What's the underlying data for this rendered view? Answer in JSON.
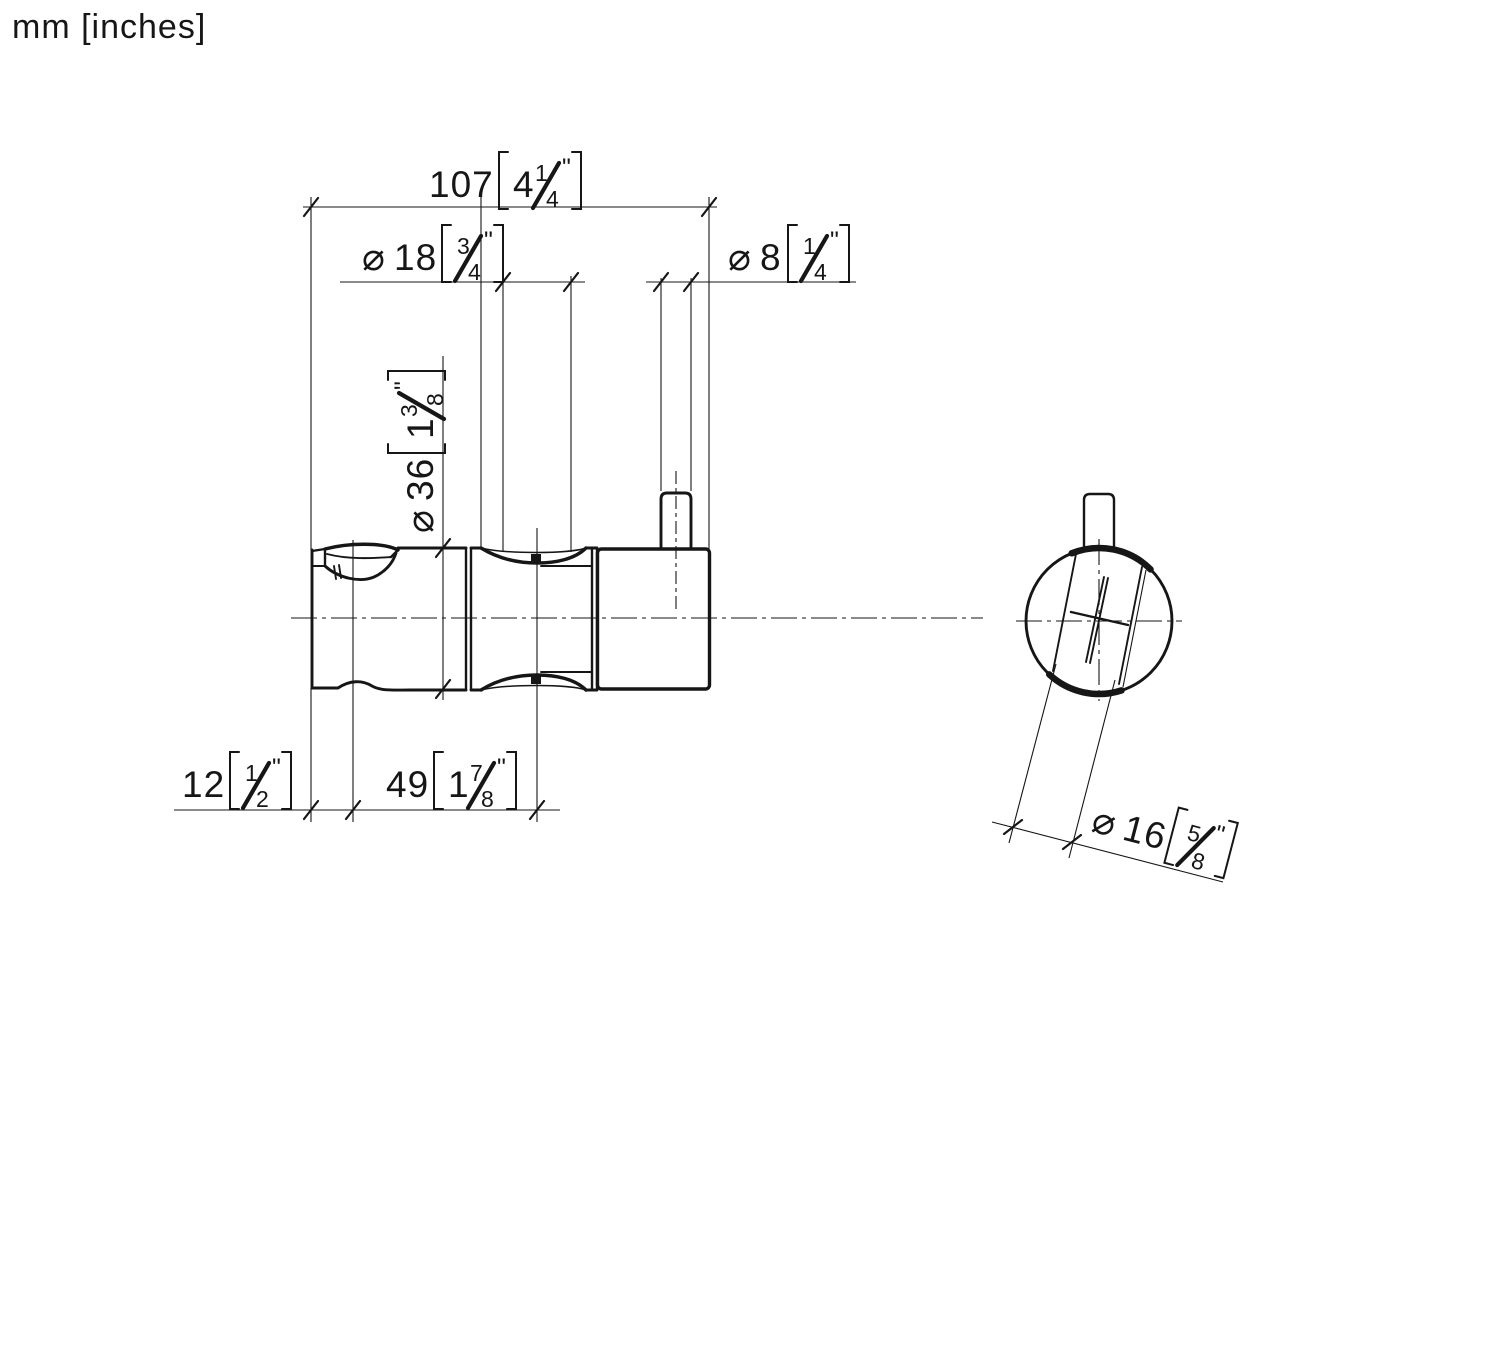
{
  "drawing": {
    "units_note": "mm [inches]",
    "type": "technical dimension drawing, side view and front view of a shower wall bracket"
  },
  "symbols": {
    "diameter": "⌀",
    "inch": "\""
  },
  "dimensions": {
    "overall_length": {
      "mm": "107",
      "inch_whole": "4",
      "frac_num": "1",
      "frac_den": "4",
      "display": "107 [4 1/4\"]"
    },
    "saddle_diameter": {
      "mm": "18",
      "frac_num": "3",
      "frac_den": "4",
      "display": "⌀18 [3/4\"]"
    },
    "pin_diameter": {
      "mm": "8",
      "frac_num": "1",
      "frac_den": "4",
      "display": "⌀8 [1/4\"]"
    },
    "body_diameter": {
      "mm": "36",
      "inch_whole": "1",
      "frac_num": "3",
      "frac_den": "8",
      "display": "⌀36 [1 3/8\"]"
    },
    "wall_offset": {
      "mm": "12",
      "frac_num": "1",
      "frac_den": "2",
      "display": "12 [1/2\"]"
    },
    "holder_length": {
      "mm": "49",
      "inch_whole": "1",
      "frac_num": "7",
      "frac_den": "8",
      "display": "49 [1 7/8\"]"
    },
    "handle_diameter": {
      "mm": "16",
      "frac_num": "5",
      "frac_den": "8",
      "display": "⌀16 [5/8\"]"
    }
  },
  "colors": {
    "line": "#161616",
    "background": "#ffffff"
  }
}
